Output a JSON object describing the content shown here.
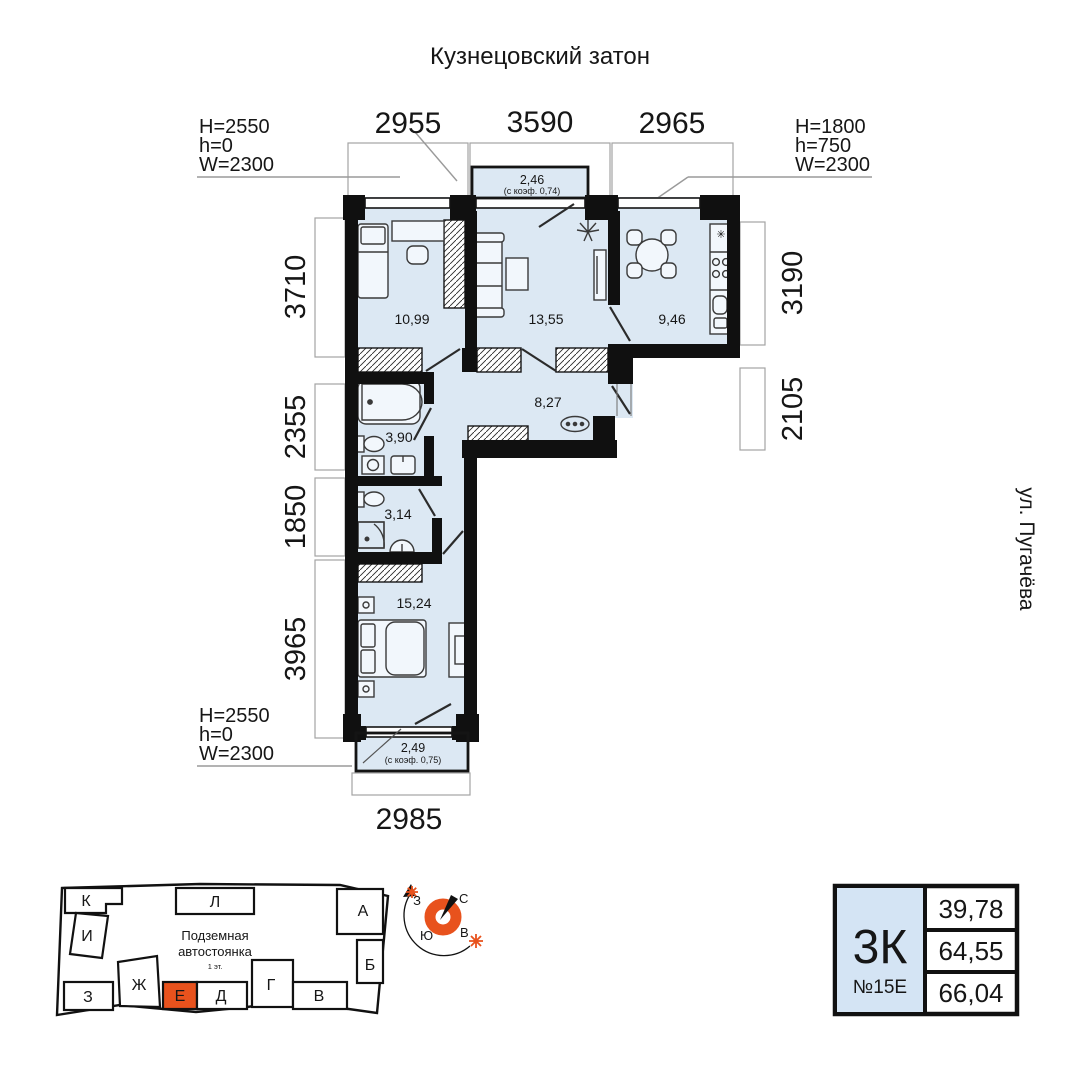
{
  "title": "Кузнецовский затон",
  "street_label": "ул. Пугачёва",
  "specs": {
    "top_left": {
      "l1": "H=2550",
      "l2": "h=0",
      "l3": "W=2300"
    },
    "top_right": {
      "l1": "H=1800",
      "l2": "h=750",
      "l3": "W=2300"
    },
    "bottom_left": {
      "l1": "H=2550",
      "l2": "h=0",
      "l3": "W=2300"
    }
  },
  "dims": {
    "top": [
      "2955",
      "3590",
      "2965"
    ],
    "left": [
      "3710",
      "2355",
      "1850",
      "3965"
    ],
    "right": [
      "3190",
      "2105"
    ],
    "bottom": [
      "2985"
    ]
  },
  "areas": {
    "bedroom1": "10,99",
    "living": "13,55",
    "kitchen": "9,46",
    "hall": "8,27",
    "bath": "3,90",
    "wc": "3,14",
    "bedroom2": "15,24"
  },
  "balconies": {
    "top": {
      "area": "2,46",
      "coef": "(с коэф. 0,74)"
    },
    "bottom": {
      "area": "2,49",
      "coef": "(с коэф. 0,75)"
    }
  },
  "misc": {
    "vent_symbol": "✳"
  },
  "site": {
    "parking1": "Подземная",
    "parking2": "автостоянка",
    "parking3": "1 эт.",
    "blocks": {
      "k": "К",
      "i": "И",
      "l": "Л",
      "a": "А",
      "b": "Б",
      "z": "З",
      "zh": "Ж",
      "e": "Е",
      "d": "Д",
      "g": "Г",
      "v": "В"
    },
    "highlighted": "Е"
  },
  "compass": {
    "n": "С",
    "s": "Ю",
    "w": "З",
    "e": "В"
  },
  "card": {
    "type": "3К",
    "unit": "№15Е",
    "v1": "39,78",
    "v2": "64,55",
    "v3": "66,04"
  },
  "colors": {
    "accent": "#E8521D",
    "floor": "#DCE8F3",
    "wall": "#101010",
    "card": "#D4E4F4"
  }
}
